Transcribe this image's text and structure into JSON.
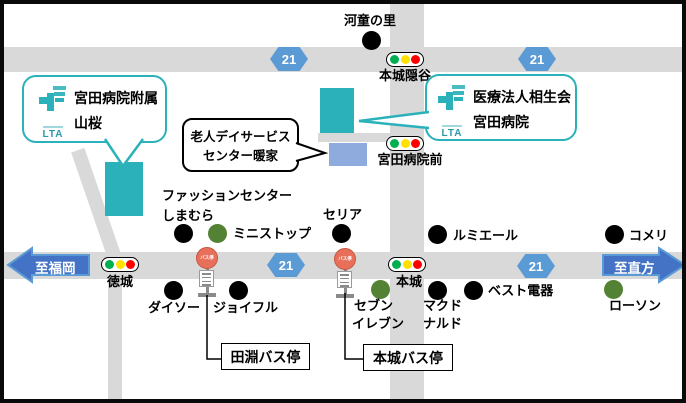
{
  "route_number": "21",
  "directions": {
    "west": "至福岡",
    "east": "至直方"
  },
  "callouts": {
    "yamazakura": {
      "line1": "宮田病院附属",
      "line2": "山桜",
      "logo": "LTA"
    },
    "miyata_hospital": {
      "line1": "医療法人相生会",
      "line2": "宮田病院",
      "logo": "LTA"
    },
    "day_service": {
      "line1": "老人デイサービス",
      "line2": "センター暖家"
    }
  },
  "signals": {
    "honjo_kakuretani": "本城隠谷",
    "miyata_byoin_mae": "宮田病院前",
    "tokujo": "徳城",
    "honjo": "本城"
  },
  "bus": {
    "sign": "バス停",
    "tabuchi_box": "田淵バス停",
    "honjo_box": "本城バス停"
  },
  "pois": {
    "kappa_no_sato": "河童の里",
    "fashion_center": "ファッションセンター",
    "shimamura": "しまむら",
    "ministop": "ミニストップ",
    "seria": "セリア",
    "lumiere": "ルミエール",
    "komeri": "コメリ",
    "daiso": "ダイソー",
    "joyful": "ジョイフル",
    "seven_l1": "セブン",
    "seven_l2": "イレブン",
    "mcdonalds_l1": "マクド",
    "mcdonalds_l2": "ナルド",
    "best_denki": "ベスト電器",
    "lawson": "ローソン"
  },
  "colors": {
    "teal": "#2ab1ba",
    "building_blue": "#8faadc",
    "road_gray": "#d9d9d9",
    "badge_blue": "#5b9bd5",
    "arrow_fill": "#4472c4",
    "arrow_border": "#5b9bd5",
    "green_dot": "#548235",
    "signal_green": "#00b050",
    "signal_yellow": "#ffe000",
    "signal_red": "#ff0000",
    "bus_stop_orange": "#e8705b"
  }
}
